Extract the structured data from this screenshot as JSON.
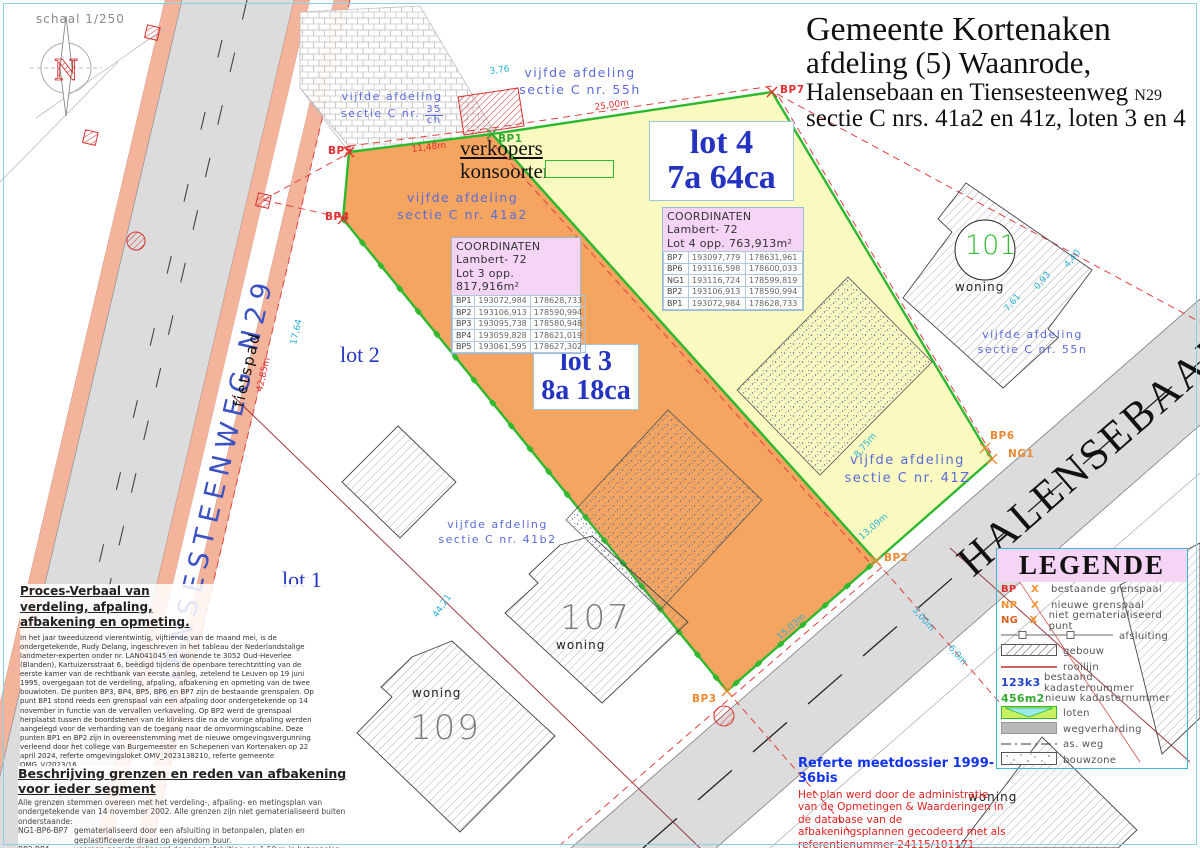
{
  "title": {
    "line1": "Gemeente Kortenaken",
    "line2": "afdeling (5) Waanrode,",
    "line3_main": "Halensebaan en Tiensesteenweg",
    "line3_suffix": "N29",
    "line4": "sectie C nrs. 41a2 en 41z, loten 3 en 4"
  },
  "scale_label": "schaal 1/250",
  "compass_letter": "N",
  "streets": {
    "tiensesteenweg": "TIENSESTEENWEG  N29",
    "fietspad": "fietspad",
    "halensebaan": "HALENSEBAAN"
  },
  "lots": {
    "lot4_name": "lot 4",
    "lot4_area": "7a 64ca",
    "lot3_name": "lot 3",
    "lot3_area": "8a 18ca",
    "lot2": "lot 2",
    "lot1": "lot 1"
  },
  "verkopers": {
    "line1": "verkopers",
    "line2": "konsoorten"
  },
  "parcels": [
    {
      "l1": "vijfde afdeling",
      "l2": "sectie C nr. 55h"
    },
    {
      "l1": "vijfde afdeling",
      "l2_prefix": "sectie C nr.",
      "num": "35",
      "den": "ch"
    },
    {
      "l1": "vijfde afdeling",
      "l2": "sectie C nr. 41a2"
    },
    {
      "l1": "vijfde afdeling",
      "l2": "sectie C nr. 41b2"
    },
    {
      "l1": "vijfde afdeling",
      "l2": "sectie C nr. 41Z"
    },
    {
      "l1": "vijfde afdeling",
      "l2": "sectie C nr. 55n"
    }
  ],
  "tables": {
    "lot3": {
      "header1": "COORDINATEN",
      "header2": "Lambert- 72",
      "header3": "Lot 3   opp. 817,916m²",
      "rows": [
        [
          "BP1",
          "193072,984",
          "178628,733"
        ],
        [
          "BP2",
          "193106,913",
          "178590,994"
        ],
        [
          "BP3",
          "193095,738",
          "178580,948"
        ],
        [
          "BP4",
          "193059,828",
          "178621,019"
        ],
        [
          "BP5",
          "193061,595",
          "178627,302"
        ]
      ]
    },
    "lot4": {
      "header1": "COORDINATEN",
      "header2": "Lambert- 72",
      "header3": "Lot 4 opp.  763,913m²",
      "rows": [
        [
          "BP7",
          "193097,779",
          "178631,961"
        ],
        [
          "BP6",
          "193116,598",
          "178600,033"
        ],
        [
          "NG1",
          "193116,724",
          "178599,819"
        ],
        [
          "BP2",
          "193106,913",
          "178590,994"
        ],
        [
          "BP1",
          "193072,984",
          "178628,733"
        ]
      ]
    }
  },
  "point_labels": [
    "BP1",
    "BP2",
    "BP3",
    "BP4",
    "BP5",
    "BP6",
    "BP7",
    "NG1"
  ],
  "houses": {
    "n101": "101",
    "n107": "107",
    "n109": "109",
    "woning": "woning"
  },
  "dimensions": {
    "d_3_76": "3,76",
    "d_25_00": "25,00m",
    "d_11_48": "11,48m",
    "d_42_85": "42,85m",
    "d_17_64": "17,64",
    "d_44_21": "44,21",
    "d_15_03": "15,03m",
    "d_8_75": "8,75m",
    "d_13_09": "13,09m",
    "d_7_61": "7,61",
    "d_0_93": "0,93",
    "d_4_40": "4,40",
    "d_3_00": "3,00m",
    "d_6_0": "6,0m"
  },
  "legend": {
    "title": "LEGENDE",
    "items": [
      {
        "code": "BP",
        "sym": "X",
        "label": "bestaande grenspaal"
      },
      {
        "code": "NP",
        "sym": "X",
        "label": "nieuwe grenspaal"
      },
      {
        "code": "NG",
        "sym": "X",
        "label": "niet gematerialiseerd punt"
      },
      {
        "label": "afsluiting"
      },
      {
        "label": "gebouw"
      },
      {
        "label": "rooilijn"
      },
      {
        "code": "123k3",
        "label": "bestaand kadasternummer"
      },
      {
        "code": "456m2",
        "label": "nieuw kadasternummer"
      },
      {
        "label": "loten"
      },
      {
        "label": "wegverharding"
      },
      {
        "label": "as. weg"
      },
      {
        "label": "bouwzone"
      }
    ]
  },
  "notes": {
    "proces_title": "Proces-Verbaal van verdeling, afpaling, afbakening en opmeting.",
    "proces_body": "In het jaar tweeduizend vierentwintig, vijftiende van de maand mei, is de ondergetekende, Rudy Delang, ingeschreven in het tableau der Nederlandstalige landmeter-experten onder nr. LAN041045 en wonende te 3052 Oud-Heverlee (Blanden), Kartuizersstraat 6, beëdigd tijdens de openbare terechtzitting van de eerste kamer van de rechtbank van eerste aanleg, zetelend te Leuven op 19 juni 1995, overgegaan tot de verdeling, afpaling, afbakening en opmeting van de twee bouwloten. De punten BP3, BP4, BP5, BP6 en BP7 zijn de bestaande grenspalen. Op punt BP1 stond reeds een grenspaal van een afpaling door ondergetekende op 14 november in functie van de vervallen verkaveling. Op BP2 werd de grenspaal herplaatst tussen de boordstenen van de klinkers die na de vorige afpaling werden aangelegd voor de verharding van de toegang naar de omvormingscabine. Deze punten BP1 en BP2 zijn in overeenstemming met de nieuwe omgevingsvergunning verleend door het college van Burgemeester en Schepenen van Kortenaken op 22 april 2024, referte omgevingsloket OMV_2023138210, referte gemeente OMG_V/2023/16.",
    "beschrijving_title": "Beschrijving grenzen en reden van afbakening voor ieder segment",
    "beschrijving_intro": "Alle grenzen stemmen overeen met het verdeling-, afpaling- en metingsplan van ondergetekende van 14 november 2002. Alle grenzen zijn niet gematerialiseerd buiten onderstaande:",
    "seg1_code": "NG1-BP6-BP7",
    "seg1_text": "gematerialiseerd door een afsluiting in betonpalen, platen en geplastificeerde draad op eigendom buur.",
    "seg2_code": "BP3-BP4",
    "seg2_text": "vooraan gematerialiseerd door een afsluiting +/- 1.50 m in betonpalen, -platen en geplastificeerde draad op eigendom buur. Achteraan tot aan gewestweg geen afsluiting of haag aanwezig.",
    "referte_title": "Referte meetdossier 1999-36bis",
    "referte_body": "Het plan werd door de  administratie van de Opmetingen & Waarderingen in de database van de afbakeningsplannen gecodeerd met als referentienummer 24115/101171"
  },
  "colors": {
    "lot3_fill": "#f5a55f",
    "lot4_fill": "#f9f9c0",
    "lot_border": "#2eb82e",
    "red": "#e03030",
    "cyan": "#2ab3d6",
    "blue_text": "#5a6bd8"
  }
}
